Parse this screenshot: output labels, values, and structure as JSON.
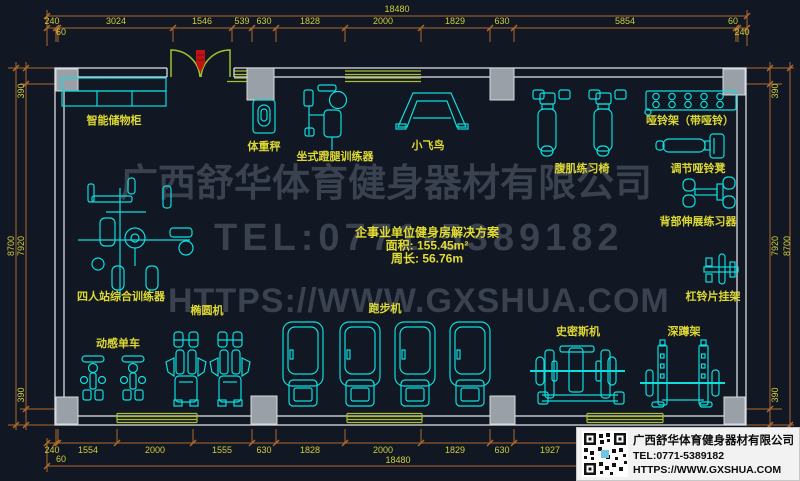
{
  "colors": {
    "bg": "#111723",
    "dim-line": "#b06a2c",
    "dim-text": "#cfcf3a",
    "label": "#ddd832",
    "cyan": "#0edede",
    "wall": "#d9dde2",
    "pilaster": "#9aa0a7",
    "window": "#abbf2e",
    "door": "#9fc42c",
    "red": "#c01414",
    "watermark": "#3a414f",
    "info-text": "#e3dc30"
  },
  "watermark": {
    "company": "广西舒华体育健身器材有限公司",
    "tel": "TEL:0771-5389182",
    "url": "HTTPS://WWW.GXSHUA.COM"
  },
  "plan_info": {
    "title": "企事业单位健身房解决方案",
    "area": "面积: 155.45m²",
    "perimeter": "周长: 56.76m"
  },
  "title_block": {
    "company": "广西舒华体育健身器材有限公司",
    "tel": "TEL:0771-5389182",
    "url": "HTTPS://WWW.GXSHUA.COM",
    "qr_icon": "qr-code-icon"
  },
  "equipment_labels": [
    {
      "text": "智能储物柜",
      "x": 114,
      "y": 120
    },
    {
      "text": "体重秤",
      "x": 264,
      "y": 146
    },
    {
      "text": "坐式蹬腿训练器",
      "x": 335,
      "y": 156
    },
    {
      "text": "小飞鸟",
      "x": 428,
      "y": 145
    },
    {
      "text": "腹肌练习椅",
      "x": 582,
      "y": 168
    },
    {
      "text": "哑铃架（带哑铃）",
      "x": 690,
      "y": 120
    },
    {
      "text": "调节哑铃凳",
      "x": 698,
      "y": 168
    },
    {
      "text": "背部伸展练习器",
      "x": 698,
      "y": 221
    },
    {
      "text": "杠铃片挂架",
      "x": 713,
      "y": 296
    },
    {
      "text": "四人站综合训练器",
      "x": 121,
      "y": 296
    },
    {
      "text": "椭圆机",
      "x": 207,
      "y": 310
    },
    {
      "text": "动感单车",
      "x": 118,
      "y": 343
    },
    {
      "text": "跑步机",
      "x": 385,
      "y": 308
    },
    {
      "text": "史密斯机",
      "x": 578,
      "y": 331
    },
    {
      "text": "深蹲架",
      "x": 684,
      "y": 331
    }
  ],
  "dimensions": {
    "unit": "mm",
    "labels": [
      {
        "text": "18480",
        "x": 397,
        "y": 9
      },
      {
        "text": "240",
        "x": 52,
        "y": 21
      },
      {
        "text": "3024",
        "x": 116,
        "y": 21
      },
      {
        "text": "1546",
        "x": 202,
        "y": 21
      },
      {
        "text": "539",
        "x": 242,
        "y": 21
      },
      {
        "text": "630",
        "x": 264,
        "y": 21
      },
      {
        "text": "1828",
        "x": 310,
        "y": 21
      },
      {
        "text": "2000",
        "x": 383,
        "y": 21
      },
      {
        "text": "1829",
        "x": 455,
        "y": 21
      },
      {
        "text": "630",
        "x": 502,
        "y": 21
      },
      {
        "text": "5854",
        "x": 625,
        "y": 21
      },
      {
        "text": "60",
        "x": 733,
        "y": 21
      },
      {
        "text": "60",
        "x": 61,
        "y": 32
      },
      {
        "text": "240",
        "x": 742,
        "y": 32
      },
      {
        "text": "240",
        "x": 52,
        "y": 450
      },
      {
        "text": "60",
        "x": 61,
        "y": 459
      },
      {
        "text": "1554",
        "x": 88,
        "y": 450
      },
      {
        "text": "2000",
        "x": 155,
        "y": 450
      },
      {
        "text": "1555",
        "x": 222,
        "y": 450
      },
      {
        "text": "630",
        "x": 264,
        "y": 450
      },
      {
        "text": "1828",
        "x": 310,
        "y": 450
      },
      {
        "text": "2000",
        "x": 383,
        "y": 450
      },
      {
        "text": "1829",
        "x": 455,
        "y": 450
      },
      {
        "text": "630",
        "x": 502,
        "y": 450
      },
      {
        "text": "1927",
        "x": 550,
        "y": 450
      },
      {
        "text": "18480",
        "x": 398,
        "y": 460
      },
      {
        "text": "390",
        "x": 21,
        "y": 91,
        "vert": true
      },
      {
        "text": "7920",
        "x": 21,
        "y": 246,
        "vert": true
      },
      {
        "text": "8700",
        "x": 11,
        "y": 246,
        "vert": true
      },
      {
        "text": "390",
        "x": 21,
        "y": 395,
        "vert": true
      },
      {
        "text": "390",
        "x": 775,
        "y": 91,
        "vert": true
      },
      {
        "text": "7920",
        "x": 775,
        "y": 246,
        "vert": true
      },
      {
        "text": "8700",
        "x": 787,
        "y": 246,
        "vert": true
      },
      {
        "text": "390",
        "x": 775,
        "y": 395,
        "vert": true
      }
    ]
  }
}
